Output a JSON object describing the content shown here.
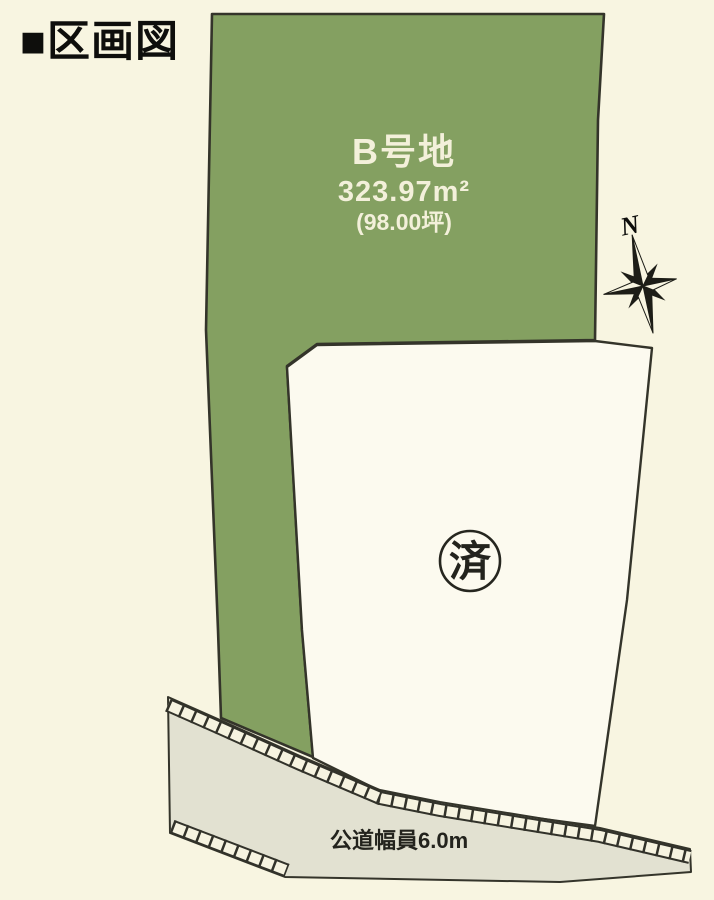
{
  "header": {
    "title": "■区画図"
  },
  "plot_map": {
    "lot_b": {
      "label": "B号地",
      "area_sqm": "323.97m²",
      "area_tsubo": "(98.00坪)"
    },
    "sold_lot": {
      "status_label": "済"
    },
    "road": {
      "label": "公道幅員6.0m"
    },
    "compass": {
      "north_label": "N"
    }
  },
  "colors": {
    "background": "#f8f5e1",
    "lot_b_fill": "#84a061",
    "sold_lot_fill": "#fcfaef",
    "road_fill": "#e2e1d1",
    "outline": "#34342a",
    "lot_label_text": "#f3f0da",
    "dark_text": "#23231d",
    "title_text": "#0e0e0c"
  }
}
